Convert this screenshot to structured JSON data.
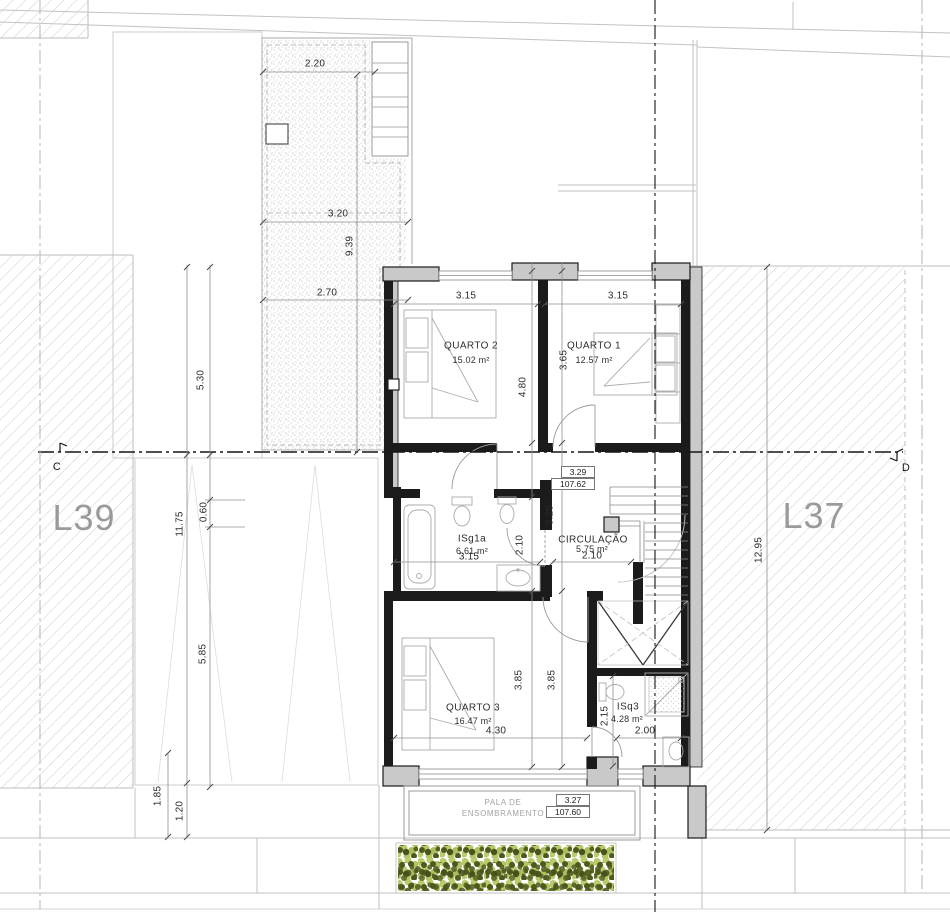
{
  "lots": {
    "left": "L39",
    "right": "L37"
  },
  "sections": {
    "left": "C",
    "right": "D"
  },
  "rooms": {
    "q2": {
      "name": "QUARTO 2",
      "area": "15.02 m²"
    },
    "q1": {
      "name": "QUARTO 1",
      "area": "12.57 m²"
    },
    "isg1a": {
      "name": "ISg1a",
      "area": "6.61 m²"
    },
    "circ": {
      "name": "CIRCULAÇÃO",
      "area": "5.75 m²"
    },
    "q3": {
      "name": "QUARTO 3",
      "area": "16.47 m²"
    },
    "isq3": {
      "name": "ISq3",
      "area": "4.28 m²"
    }
  },
  "canopy": {
    "line1": "PALA DE",
    "line2": "ENSOMBRAMENTO"
  },
  "levels": {
    "upper": {
      "rel": "3.29",
      "abs": "107.62"
    },
    "canopy": {
      "rel": "3.27",
      "abs": "107.60"
    }
  },
  "dims": {
    "patio_w1": "2.20",
    "patio_w2": "3.20",
    "patio_len": "9.39",
    "patio_w3": "2.70",
    "left_a": "5.30",
    "left_b": "11.75",
    "left_c": "0.60",
    "left_d": "5.85",
    "left_e": "1.85",
    "left_f": "1.20",
    "right_len": "12.95",
    "q2_w": "3.15",
    "q1_w": "3.15",
    "q2_h": "4.80",
    "q1_h": "3.65",
    "hall_h": "3.25",
    "bath_h": "2.10",
    "bath_w": "3.15",
    "circ_w": "2.10",
    "q3_h1": "3.85",
    "q3_h2": "3.85",
    "q3_w": "4.30",
    "isq3_h": "2.15",
    "isq3_w": "2.00"
  },
  "colors": {
    "wall": "#1b1b1b",
    "pier": "#c9c9c9",
    "hatch": "#cfcfcf",
    "veg_light": "#b7cd6d",
    "veg_dark": "#4e5a1d",
    "lot_text": "#9a9a9a"
  }
}
